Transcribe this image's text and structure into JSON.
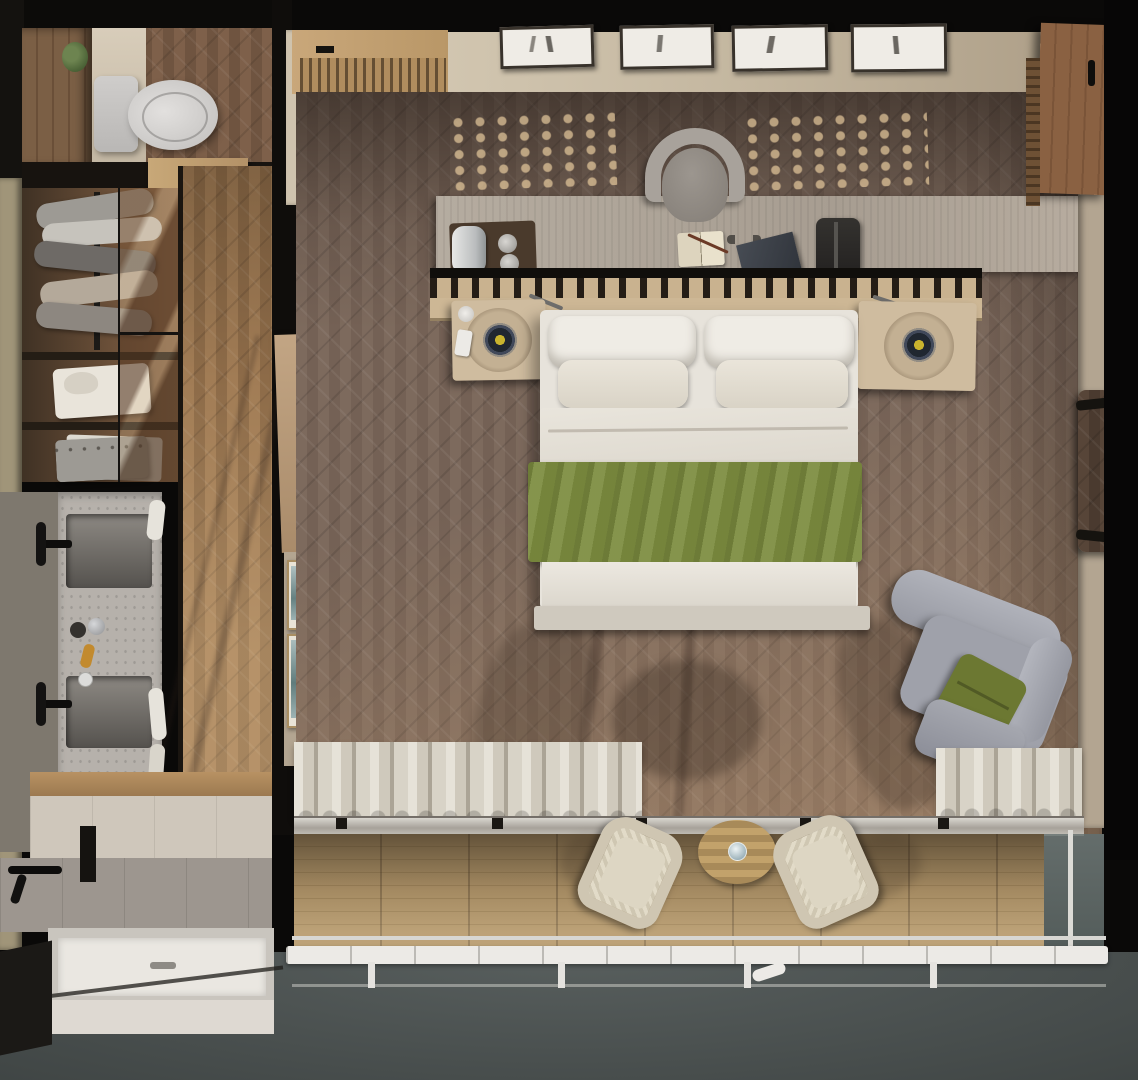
{
  "scene": {
    "type": "top-down-architectural-render",
    "description_objects": {
      "bathroom": [
        "toilet",
        "plant",
        "tall-cabinet",
        "wardrobe-hanging-clothes",
        "glass-wardrobe-door",
        "shelf-folded-shirt",
        "shelf-folded-sweater",
        "double-sink-vanity",
        "black-faucets",
        "toiletry-bottles",
        "hand-towels",
        "walk-in-shower",
        "black-shower-fixture",
        "shower-niche",
        "shower-tray"
      ],
      "bedroom": [
        "entry-door",
        "entry-mat",
        "wall-art-frames",
        "desk-console",
        "desk-chair",
        "coffee-tray",
        "coffee-machine",
        "cups",
        "open-notebook",
        "pen",
        "folder",
        "travel-bag",
        "headboard-slat-shelf",
        "nightstand-left",
        "nightstand-right",
        "speaker-left",
        "speaker-right",
        "mug",
        "phone",
        "double-bed",
        "back-pillows",
        "lumbar-pillows",
        "duvet",
        "green-throw-blanket",
        "footboard-bench",
        "lounge-armchair",
        "green-cushion",
        "ottoman",
        "luggage-rack",
        "bathroom-door",
        "small-wall-art",
        "curtains"
      ],
      "balcony": [
        "wood-deck",
        "outdoor-chair-left",
        "outdoor-chair-right",
        "round-side-table",
        "drinking-glass",
        "white-railing",
        "glass-balustrade"
      ]
    },
    "counts": {
      "wall_art_frames_top": 4,
      "small_wall_art_left": 2,
      "outdoor_chairs": 2,
      "sinks": 2,
      "pillows": 4
    }
  },
  "palette": {
    "frame_black": "#0c0b09",
    "wall_beige": "#cfc3ae",
    "wall_beige_dark": "#b3a591",
    "outer_wall_olive": "#a09579",
    "floor_dark_base": "#796759",
    "floor_corridor_light": "#a17c55",
    "toilet_white": "#d7d5d3",
    "cabinet_wood": "#7b5f45",
    "garment_gray": "#9d9a94",
    "shirt_white": "#e9e4da",
    "marble_gray": "#b6b1ab",
    "basin_dark": "#5f5c58",
    "amber_bottle": "#c28a2e",
    "tile_beige": "#cfc7bb",
    "tile_gray": "#9d968f",
    "tray_white": "#eae7e1",
    "ground_gray": "#4e5554",
    "desk_wood": "#aba195",
    "chair_gray": "#a8a29b",
    "headboard_slat": "#cdb795",
    "nightstand_wood": "#cfbc9f",
    "speaker_yellow": "#c9b42e",
    "bed_white": "#e7e3db",
    "pillow_white": "#efece5",
    "blanket_green": "#7c8c3f",
    "footboard_gray": "#cfc9be",
    "armchair_gray": "#9fa1aa",
    "cushion_green": "#6c7832",
    "curtain_cream": "#d9d4c9",
    "deck_wood": "#b2966a",
    "railing_white": "#eceae6",
    "wicker_cream": "#d6cdbb",
    "table_wood": "#c2a26b",
    "art_teal": "#85a0a0",
    "door_wood": "#8a6142"
  }
}
